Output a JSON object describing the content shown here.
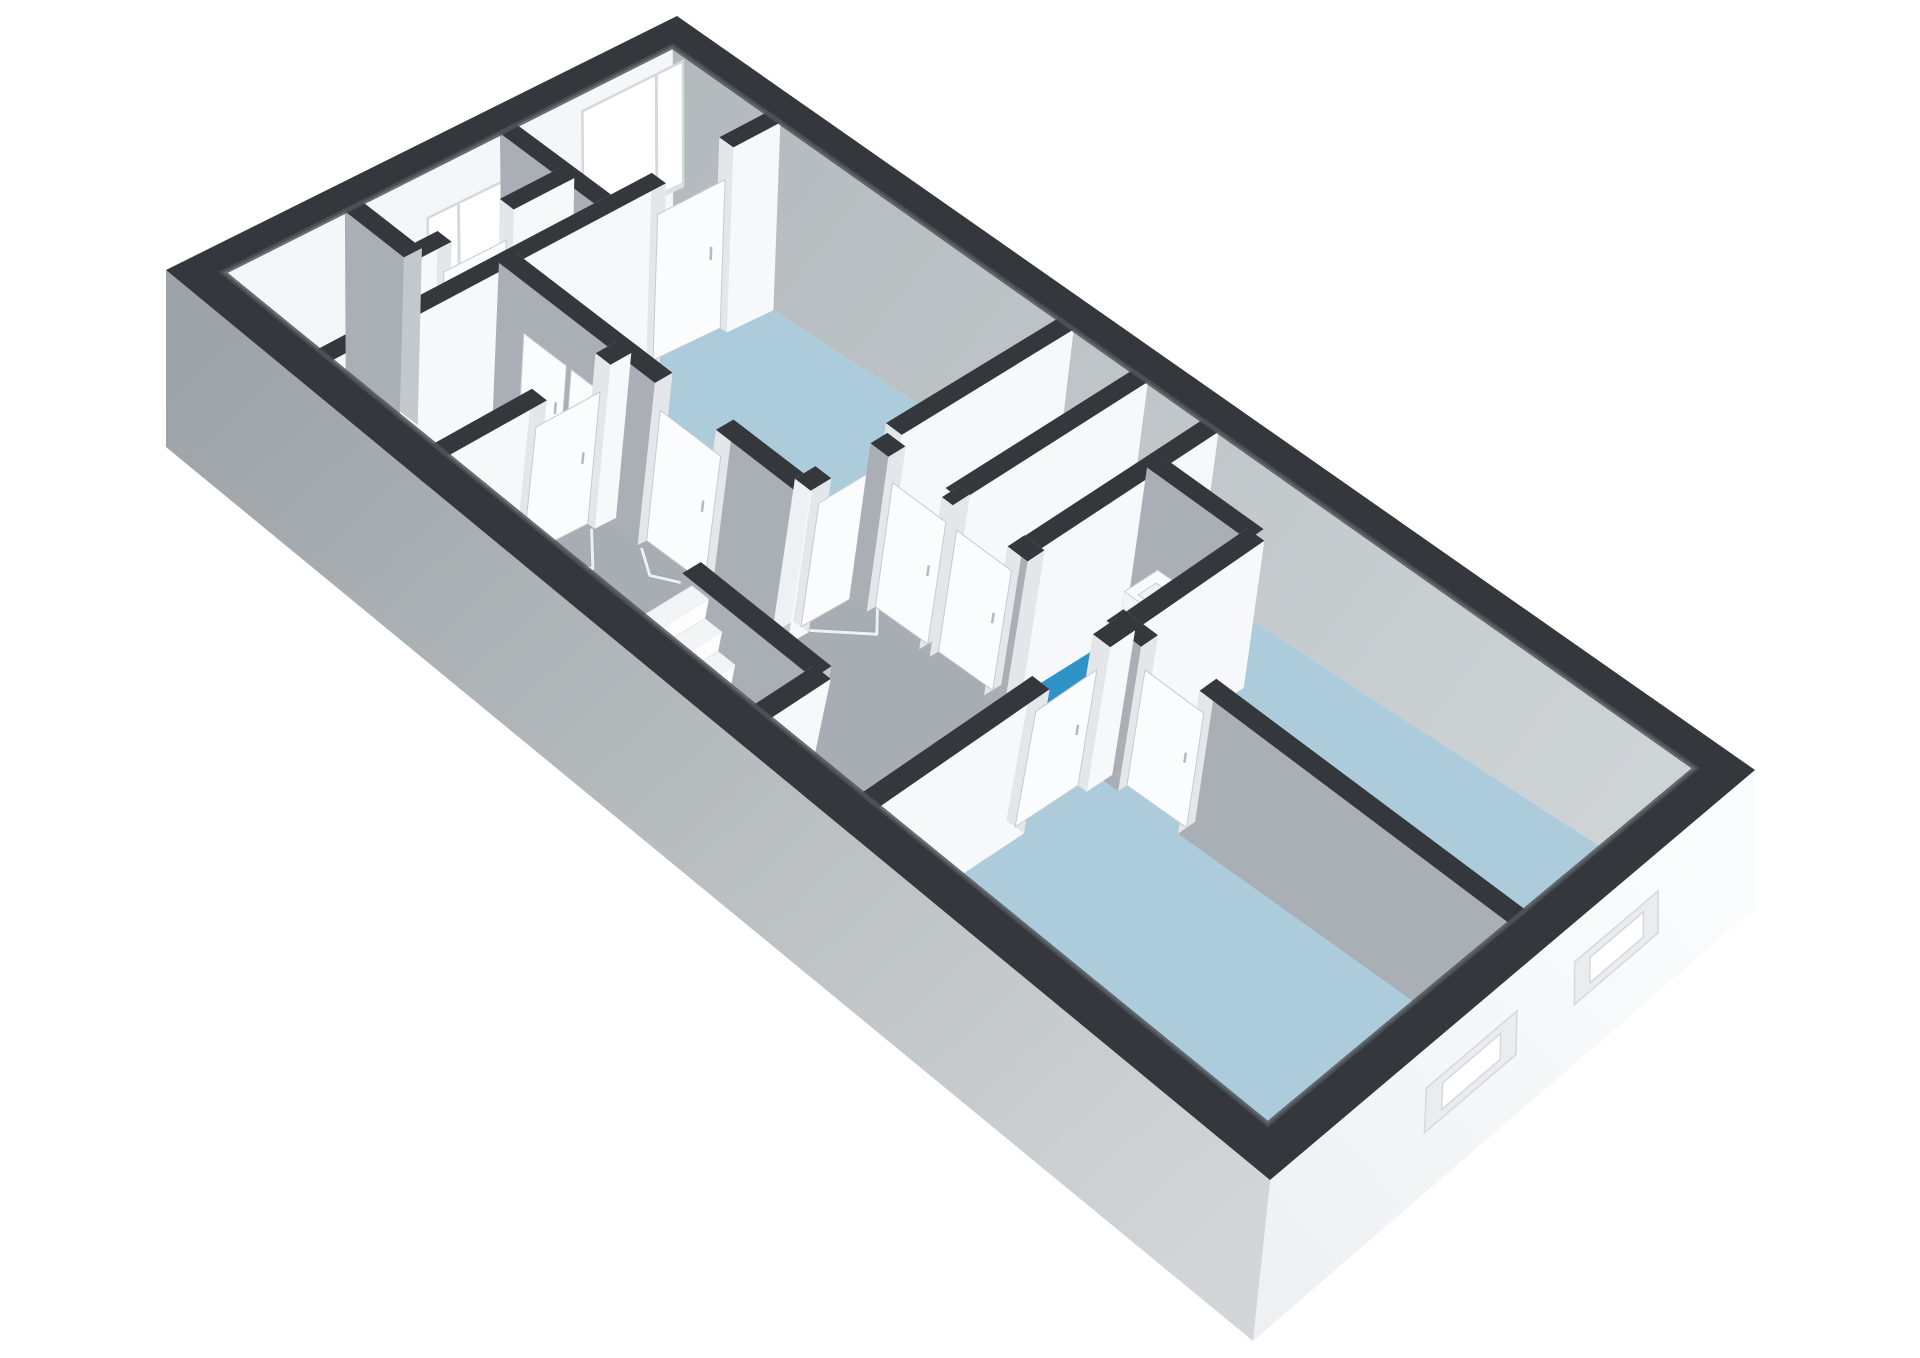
{
  "scene": {
    "kind": "3d-floorplan-axonometric",
    "background": "#ffffff",
    "visible_text": []
  },
  "colors": {
    "cap": "#34383c",
    "capStreak": "#4d5358",
    "extSW": "#a9aeb2",
    "extSWLight": "#d2d6d8",
    "extSE": "#eef1f3",
    "extSELight": "#fbfcfd",
    "neInnerFar": "#b0b6ba",
    "neInnerNear": "#cdd2d5",
    "nwInner": "#f4f6f8",
    "wallWhiteFar": "#eef1f3",
    "wallWhiteNear": "#f6f8f9",
    "wallGrayNear": "#a9afb4",
    "wallGrayFar": "#c3c8cc",
    "jamb": "#e3e7e9",
    "leaf": "#fbfcfd",
    "leafEdge": "#c6cbce",
    "handle": "#b5babe",
    "floorBlue": "#adccdb",
    "floorGray": "#a7adb2",
    "floorBright": "#2e93c6",
    "floorWhite": "#edf0f2",
    "winFrame": "#d5d9dc",
    "sill": "#dde1e4",
    "seRecess": "#e9edef",
    "treadTop": "#f2f4f6",
    "riser": "#fdfdfe",
    "stairSide": "#dfe3e6",
    "fixWhite": "#f8fafb",
    "fixFront": "#f1f4f5",
    "fixSide": "#e6eaec",
    "fixLine": "#c9ced1",
    "chev": "#eef1f2",
    "chevShadow": "#9ba1a6"
  },
  "calibration": {
    "top": {
      "p00": [
        166,
        270
      ],
      "p10": [
        1270,
        1180
      ],
      "p01": [
        677,
        16
      ],
      "p11": [
        1755,
        770
      ]
    },
    "floor": {
      "p00": [
        166,
        447
      ],
      "p10": [
        1253,
        1341
      ],
      "p01": [
        679,
        219
      ],
      "p11": [
        1755,
        908
      ]
    }
  },
  "shell": {
    "u": [
      0.026,
      0.974
    ],
    "v": [
      0.06,
      0.94
    ]
  },
  "rooms": [
    {
      "name": "entrance-hall",
      "color": "floorWhite",
      "poly": [
        [
          0.026,
          0.06
        ],
        [
          0.135,
          0.06
        ],
        [
          0.135,
          0.94
        ],
        [
          0.026,
          0.94
        ]
      ]
    },
    {
      "name": "living-room",
      "color": "floorBlue",
      "poly": [
        [
          0.135,
          0.4
        ],
        [
          0.43,
          0.4
        ],
        [
          0.43,
          0.94
        ],
        [
          0.135,
          0.94
        ]
      ]
    },
    {
      "name": "bathroom",
      "color": "floorBright",
      "poly": [
        [
          0.135,
          0.06
        ],
        [
          0.255,
          0.06
        ],
        [
          0.255,
          0.4
        ],
        [
          0.135,
          0.4
        ]
      ]
    },
    {
      "name": "corridor",
      "color": "floorGray",
      "poly": [
        [
          0.255,
          0.06
        ],
        [
          0.655,
          0.06
        ],
        [
          0.655,
          0.55
        ],
        [
          0.43,
          0.55
        ],
        [
          0.43,
          0.4
        ],
        [
          0.255,
          0.4
        ]
      ]
    },
    {
      "name": "closet-1",
      "color": "floorWhite",
      "poly": [
        [
          0.43,
          0.55
        ],
        [
          0.5,
          0.55
        ],
        [
          0.5,
          0.94
        ],
        [
          0.43,
          0.94
        ]
      ]
    },
    {
      "name": "closet-2",
      "color": "floorWhite",
      "poly": [
        [
          0.5,
          0.55
        ],
        [
          0.565,
          0.55
        ],
        [
          0.565,
          0.94
        ],
        [
          0.5,
          0.94
        ]
      ]
    },
    {
      "name": "toilet-room",
      "color": "floorBright",
      "poly": [
        [
          0.565,
          0.55
        ],
        [
          0.655,
          0.55
        ],
        [
          0.655,
          0.82
        ],
        [
          0.565,
          0.82
        ]
      ]
    },
    {
      "name": "bedroom-1",
      "color": "floorBlue",
      "poly": [
        [
          0.655,
          0.55
        ],
        [
          0.974,
          0.55
        ],
        [
          0.974,
          0.94
        ],
        [
          0.565,
          0.94
        ],
        [
          0.565,
          0.82
        ],
        [
          0.655,
          0.82
        ]
      ]
    },
    {
      "name": "bedroom-2",
      "color": "floorBlue",
      "poly": [
        [
          0.655,
          0.06
        ],
        [
          0.974,
          0.06
        ],
        [
          0.974,
          0.55
        ],
        [
          0.655,
          0.55
        ]
      ]
    }
  ],
  "walls": [
    {
      "name": "hall-divider",
      "axis": "u",
      "pos": 0.6,
      "from": 0.026,
      "to": 0.135,
      "leafs": [
        {
          "span": [
            0.085,
            0.13
          ],
          "surface": true
        }
      ]
    },
    {
      "name": "nw-closet-front",
      "axis": "v",
      "pos": 0.09,
      "from": 0.3,
      "to": 0.6,
      "openings": [
        [
          0.36,
          0.48
        ]
      ],
      "leafs": [
        {
          "span": [
            0.36,
            0.48
          ]
        }
      ]
    },
    {
      "name": "nw-closet-side",
      "axis": "u",
      "pos": 0.3,
      "from": 0.026,
      "to": 0.09
    },
    {
      "name": "hall-living",
      "axis": "v",
      "pos": 0.135,
      "from": 0.06,
      "to": 0.94,
      "openings": [
        [
          0.7,
          0.84
        ]
      ],
      "leafs": [
        {
          "span": [
            0.7,
            0.84
          ]
        }
      ]
    },
    {
      "name": "bath-living",
      "axis": "u",
      "pos": 0.4,
      "from": 0.135,
      "to": 0.43,
      "openings": [
        [
          0.295,
          0.355
        ]
      ],
      "leafs": [
        {
          "span": [
            0.295,
            0.355
          ]
        },
        {
          "span": [
            0.165,
            0.21
          ],
          "surface": true,
          "zh": 0.72
        },
        {
          "span": [
            0.215,
            0.26
          ],
          "surface": true,
          "zh": 0.72
        }
      ]
    },
    {
      "name": "bath-corridor",
      "axis": "v",
      "pos": 0.255,
      "from": 0.06,
      "to": 0.4,
      "openings": [
        [
          0.24,
          0.36
        ]
      ],
      "leafs": [
        {
          "span": [
            0.24,
            0.36
          ]
        }
      ]
    },
    {
      "name": "living-corridor",
      "axis": "v",
      "pos": 0.43,
      "from": 0.4,
      "to": 0.94,
      "openings": [
        [
          0.44,
          0.58
        ]
      ],
      "leafs": [
        {
          "span": [
            0.44,
            0.58
          ]
        }
      ]
    },
    {
      "name": "corridor-north",
      "axis": "u",
      "pos": 0.55,
      "from": 0.43,
      "to": 0.974,
      "openings": [
        [
          0.447,
          0.497
        ],
        [
          0.507,
          0.557
        ],
        [
          0.575,
          0.645
        ],
        [
          0.675,
          0.725
        ]
      ],
      "leafs": [
        {
          "span": [
            0.447,
            0.497
          ]
        },
        {
          "span": [
            0.507,
            0.557
          ]
        },
        {
          "span": [
            0.675,
            0.725
          ]
        }
      ]
    },
    {
      "name": "closet-divider",
      "axis": "v",
      "pos": 0.5,
      "from": 0.55,
      "to": 0.94
    },
    {
      "name": "closet-toilet",
      "axis": "v",
      "pos": 0.565,
      "from": 0.55,
      "to": 0.94
    },
    {
      "name": "toilet-back",
      "axis": "u",
      "pos": 0.82,
      "from": 0.565,
      "to": 0.655
    },
    {
      "name": "toilet-bedroom1",
      "axis": "v",
      "pos": 0.655,
      "from": 0.55,
      "to": 0.82
    },
    {
      "name": "corridor-bedroom2",
      "axis": "v",
      "pos": 0.655,
      "from": 0.06,
      "to": 0.55,
      "openings": [
        [
          0.38,
          0.5
        ]
      ],
      "leafs": [
        {
          "span": [
            0.38,
            0.5
          ]
        }
      ]
    },
    {
      "name": "stair-side",
      "axis": "u",
      "pos": 0.17,
      "from": 0.44,
      "to": 0.56
    },
    {
      "name": "stair-end",
      "axis": "v",
      "pos": 0.56,
      "from": 0.06,
      "to": 0.17
    }
  ],
  "chevrons": [
    {
      "name": "door-swing-bathroom",
      "pts": [
        [
          0.262,
          0.245
        ],
        [
          0.295,
          0.3
        ],
        [
          0.262,
          0.355
        ]
      ]
    },
    {
      "name": "door-swing-living-b",
      "pts": [
        [
          0.3,
          0.382
        ],
        [
          0.325,
          0.352
        ],
        [
          0.35,
          0.382
        ]
      ]
    },
    {
      "name": "door-swing-living-d",
      "pts": [
        [
          0.437,
          0.445
        ],
        [
          0.468,
          0.51
        ],
        [
          0.437,
          0.575
        ]
      ]
    },
    {
      "name": "door-swing-toilet",
      "pts": [
        [
          0.578,
          0.532
        ],
        [
          0.61,
          0.502
        ],
        [
          0.642,
          0.532
        ]
      ]
    },
    {
      "name": "door-swing-bedroom2",
      "pts": [
        [
          0.648,
          0.385
        ],
        [
          0.617,
          0.44
        ],
        [
          0.648,
          0.495
        ]
      ]
    }
  ],
  "windows_nw": [
    {
      "name": "window-hall-small",
      "v": [
        0.44,
        0.6
      ],
      "z": [
        0.38,
        0.74
      ],
      "mullion": 0.5
    },
    {
      "name": "window-living-large",
      "v": [
        0.75,
        0.962
      ],
      "z": [
        0.28,
        0.9
      ],
      "mullion": 0.905
    }
  ],
  "windows_se": [
    {
      "name": "window-se-upper",
      "v": [
        0.6,
        0.78
      ],
      "z": [
        0.42,
        0.72
      ]
    },
    {
      "name": "window-se-lower",
      "v": [
        0.3,
        0.48
      ],
      "z": [
        0.42,
        0.72
      ]
    }
  ],
  "stairs": {
    "u0": 0.445,
    "du": 0.0158,
    "n": 7,
    "v": [
      0.065,
      0.165
    ],
    "z0": 0.92,
    "dz": 0.13
  },
  "fixtures": {
    "sink": {
      "u": [
        0.585,
        0.645
      ],
      "v": [
        0.735,
        0.805
      ],
      "h": 0.42
    },
    "toilet": {
      "tank": {
        "u": [
          0.03,
          0.048
        ],
        "v": [
          0.41,
          0.51
        ],
        "h": 0.34
      },
      "bowl": {
        "c": [
          0.066,
          0.46
        ],
        "ru": 0.02,
        "rv": 0.038,
        "h": 0.2
      }
    }
  }
}
